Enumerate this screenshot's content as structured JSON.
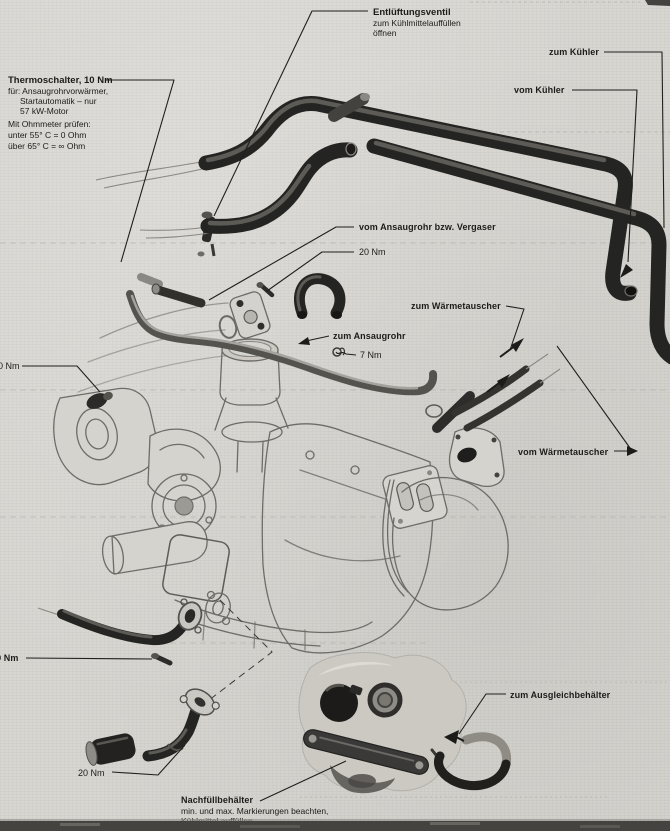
{
  "figure": {
    "description": "Exploded cooling-system diagram of an engine (workshop manual scan, German)",
    "colors": {
      "paper": "#d8d6d1",
      "ink": "#1d1c1a",
      "hose_dark": "#242422",
      "line_art": "#6e6c68"
    },
    "labels": {
      "entlueftungsventil": {
        "title": "Entlüftungsventil",
        "line2": "zum Kühlmittelauffüllen",
        "line3": "öffnen"
      },
      "zum_kuehler": "zum Kühler",
      "vom_kuehler": "vom Kühler",
      "thermoschalter": {
        "title": "Thermoschalter, 10 Nm",
        "lines": [
          "für: Ansaugrohrvorwärmer,",
          "Startautomatik – nur",
          "57 kW-Motor",
          "Mit Ohmmeter prüfen:",
          "unter 55° C = 0 Ohm",
          "über 65° C = ∞ Ohm"
        ]
      },
      "vom_ansaugrohr": "vom Ansaugrohr bzw. Vergaser",
      "nm20_top": "20 Nm",
      "zum_waermetauscher": "zum Wärmetauscher",
      "zum_ansaugrohr": "zum Ansaugrohr",
      "nm7": "7 Nm",
      "vom_waermetauscher": "vom Wärmetauscher",
      "nm10_left": "10 Nm",
      "nm10_lower": "10 Nm",
      "nm20_bottom": "20 Nm",
      "zum_ausgleichbehaelter": "zum Ausgleichbehälter",
      "nachfuellbehaelter": {
        "title": "Nachfüllbehälter",
        "line2": "min. und max. Markierungen beachten,",
        "line3": "Kühlmittel auffüllen"
      }
    }
  }
}
